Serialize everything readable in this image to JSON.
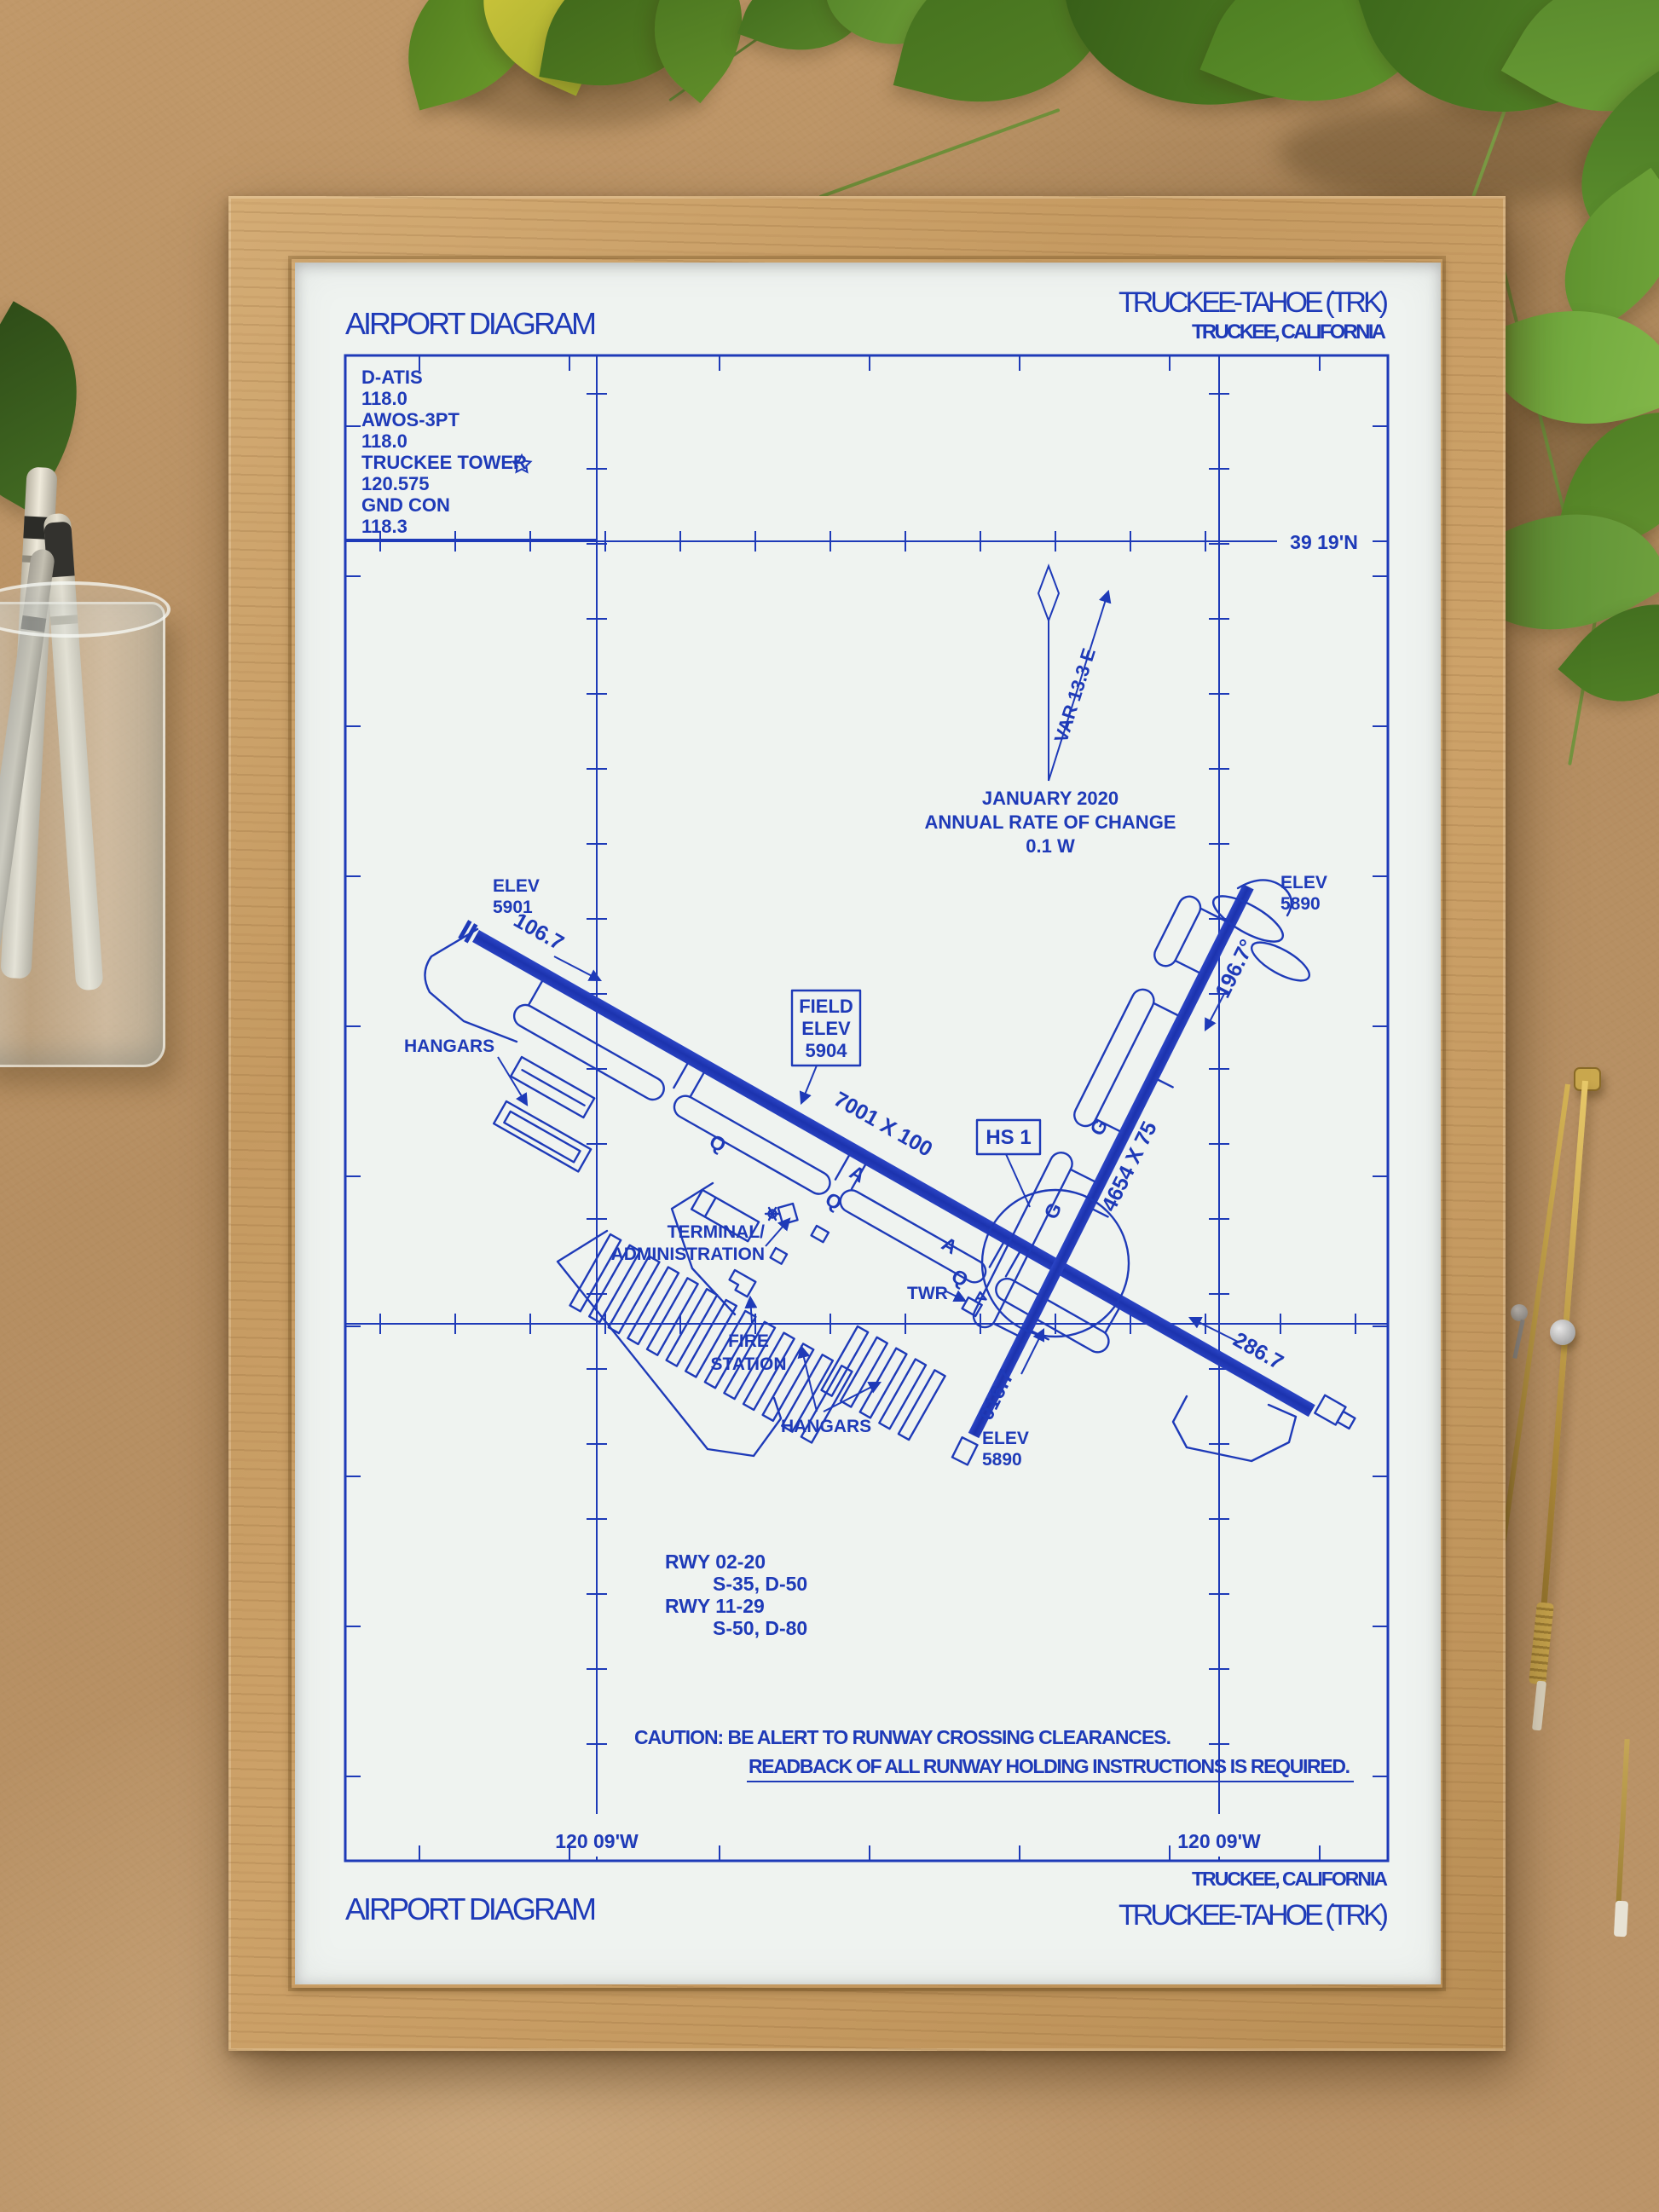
{
  "ink": "#1e3ab8",
  "header": {
    "title": "AIRPORT DIAGRAM",
    "airport": "TRUCKEE-TAHOE (TRK)",
    "city": "TRUCKEE, CALIFORNIA"
  },
  "footer": {
    "title": "AIRPORT DIAGRAM",
    "city": "TRUCKEE, CALIFORNIA",
    "airport": "TRUCKEE-TAHOE (TRK)"
  },
  "comm": {
    "lines": [
      "D-ATIS",
      "118.0",
      "AWOS-3PT",
      "118.0",
      "TRUCKEE TOWER",
      "120.575",
      "GND CON",
      "118.3"
    ]
  },
  "coordinates": {
    "lat": "39 19'N",
    "lon_left": "120 09'W",
    "lon_right": "120 09'W"
  },
  "compass": {
    "var": "VAR 13.3 E",
    "date": "JANUARY 2020",
    "rate_label": "ANNUAL RATE OF CHANGE",
    "rate": "0.1  W"
  },
  "field_elev": {
    "l1": "FIELD",
    "l2": "ELEV",
    "l3": "5904"
  },
  "hot_spot": "HS 1",
  "runway_11_29": {
    "size": "7001 X 100",
    "hdg_11": "106.7",
    "hdg_29": "286.7",
    "elev_11_l1": "ELEV",
    "elev_11_l2": "5901"
  },
  "runway_02_20": {
    "size": "4654 X 75",
    "hdg_02": "016.7",
    "hdg_20": "196.7°",
    "elev_20_l1": "ELEV",
    "elev_20_l2": "5890",
    "elev_02_l1": "ELEV",
    "elev_02_l2": "5890"
  },
  "labels": {
    "hangars_west": "HANGARS",
    "hangars_south": "HANGARS",
    "terminal_l1": "TERMINAL/",
    "terminal_l2": "ADMINISTRATION",
    "tower": "TWR",
    "fire_l1": "FIRE",
    "fire_l2": "STATION"
  },
  "taxiways": {
    "q": "Q",
    "g": "G",
    "a": "A"
  },
  "runway_data": {
    "l1": "RWY 02-20",
    "l2": "S-35, D-50",
    "l3": "RWY 11-29",
    "l4": "S-50, D-80"
  },
  "caution": {
    "l1": "CAUTION: BE ALERT TO RUNWAY CROSSING CLEARANCES.",
    "l2": "READBACK OF ALL RUNWAY HOLDING INSTRUCTIONS IS REQUIRED."
  }
}
